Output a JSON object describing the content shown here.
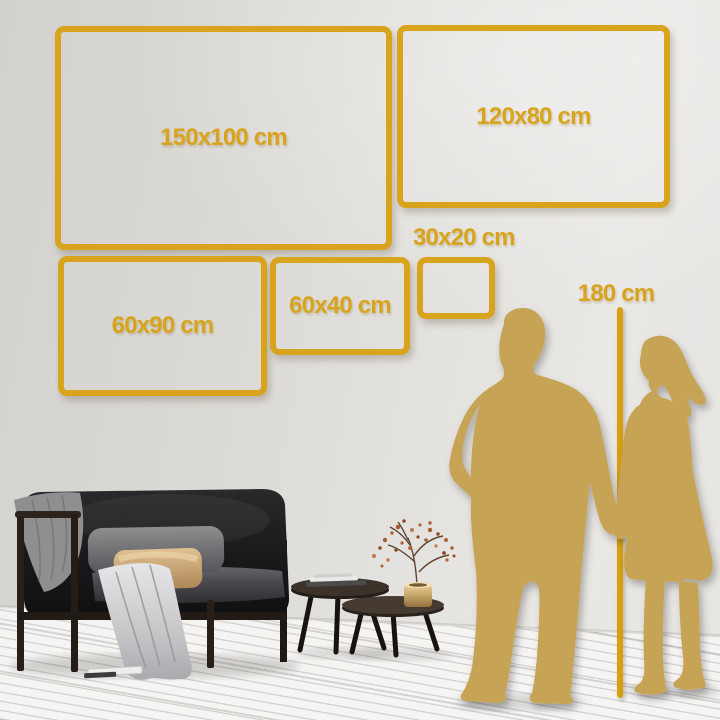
{
  "size_guide": {
    "frames": [
      {
        "id": "150x100",
        "label": "150x100 cm"
      },
      {
        "id": "120x80",
        "label": "120x80 cm"
      },
      {
        "id": "60x90",
        "label": "60x90 cm"
      },
      {
        "id": "60x40",
        "label": "60x40 cm"
      },
      {
        "id": "30x20",
        "label": "30x20 cm"
      }
    ],
    "height_label": "180 cm"
  },
  "theme": {
    "gold": "#D8A41E",
    "line": "#D6A00E",
    "figure": "#C7A455",
    "wall_left": "#D3D1CE",
    "wall_right": "#EAE8E5",
    "floor": "#F2F1EF"
  }
}
